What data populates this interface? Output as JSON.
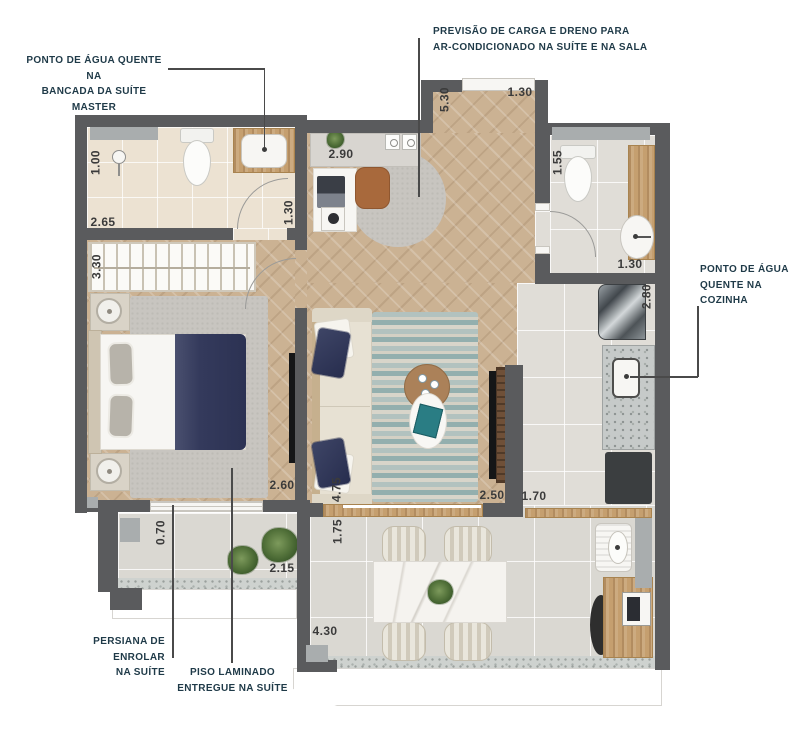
{
  "plan": {
    "title": "apartment floor plan",
    "annotations": {
      "hot_water_suite": {
        "l1": "PONTO DE ÁGUA QUENTE NA",
        "l2": "BANCADA DA SUÍTE MASTER"
      },
      "ac_provision": {
        "l1": "PREVISÃO DE CARGA E DRENO PARA",
        "l2": "AR-CONDICIONADO NA SUÍTE E NA SALA"
      },
      "hot_water_kitchen": {
        "l1": "PONTO DE ÁGUA",
        "l2": "QUENTE NA",
        "l3": "COZINHA"
      },
      "roller_blind": {
        "l1": "PERSIANA DE ENROLAR",
        "l2": "NA SUÍTE"
      },
      "laminate_floor": {
        "l1": "PISO LAMINADO",
        "l2": "ENTREGUE NA SUÍTE"
      }
    },
    "dims": [
      {
        "v": "1.00"
      },
      {
        "v": "2.65"
      },
      {
        "v": "1.30"
      },
      {
        "v": "3.30"
      },
      {
        "v": "2.90"
      },
      {
        "v": "5.30"
      },
      {
        "v": "1.30"
      },
      {
        "v": "1.55"
      },
      {
        "v": "1.30"
      },
      {
        "v": "2.80"
      },
      {
        "v": "2.60"
      },
      {
        "v": "4.75"
      },
      {
        "v": "2.50"
      },
      {
        "v": "1.70"
      },
      {
        "v": "0.70"
      },
      {
        "v": "2.15"
      },
      {
        "v": "1.75"
      },
      {
        "v": "4.30"
      }
    ],
    "colors": {
      "wall": "#5a5b5d",
      "wood_floor": "#cbb293",
      "annotation_text": "#1f3a48",
      "dimension_text": "#3b3b3b",
      "navy_fabric": "#343b60",
      "teal_rug": "#93afae",
      "counter_wood": "#c59f6f"
    }
  }
}
